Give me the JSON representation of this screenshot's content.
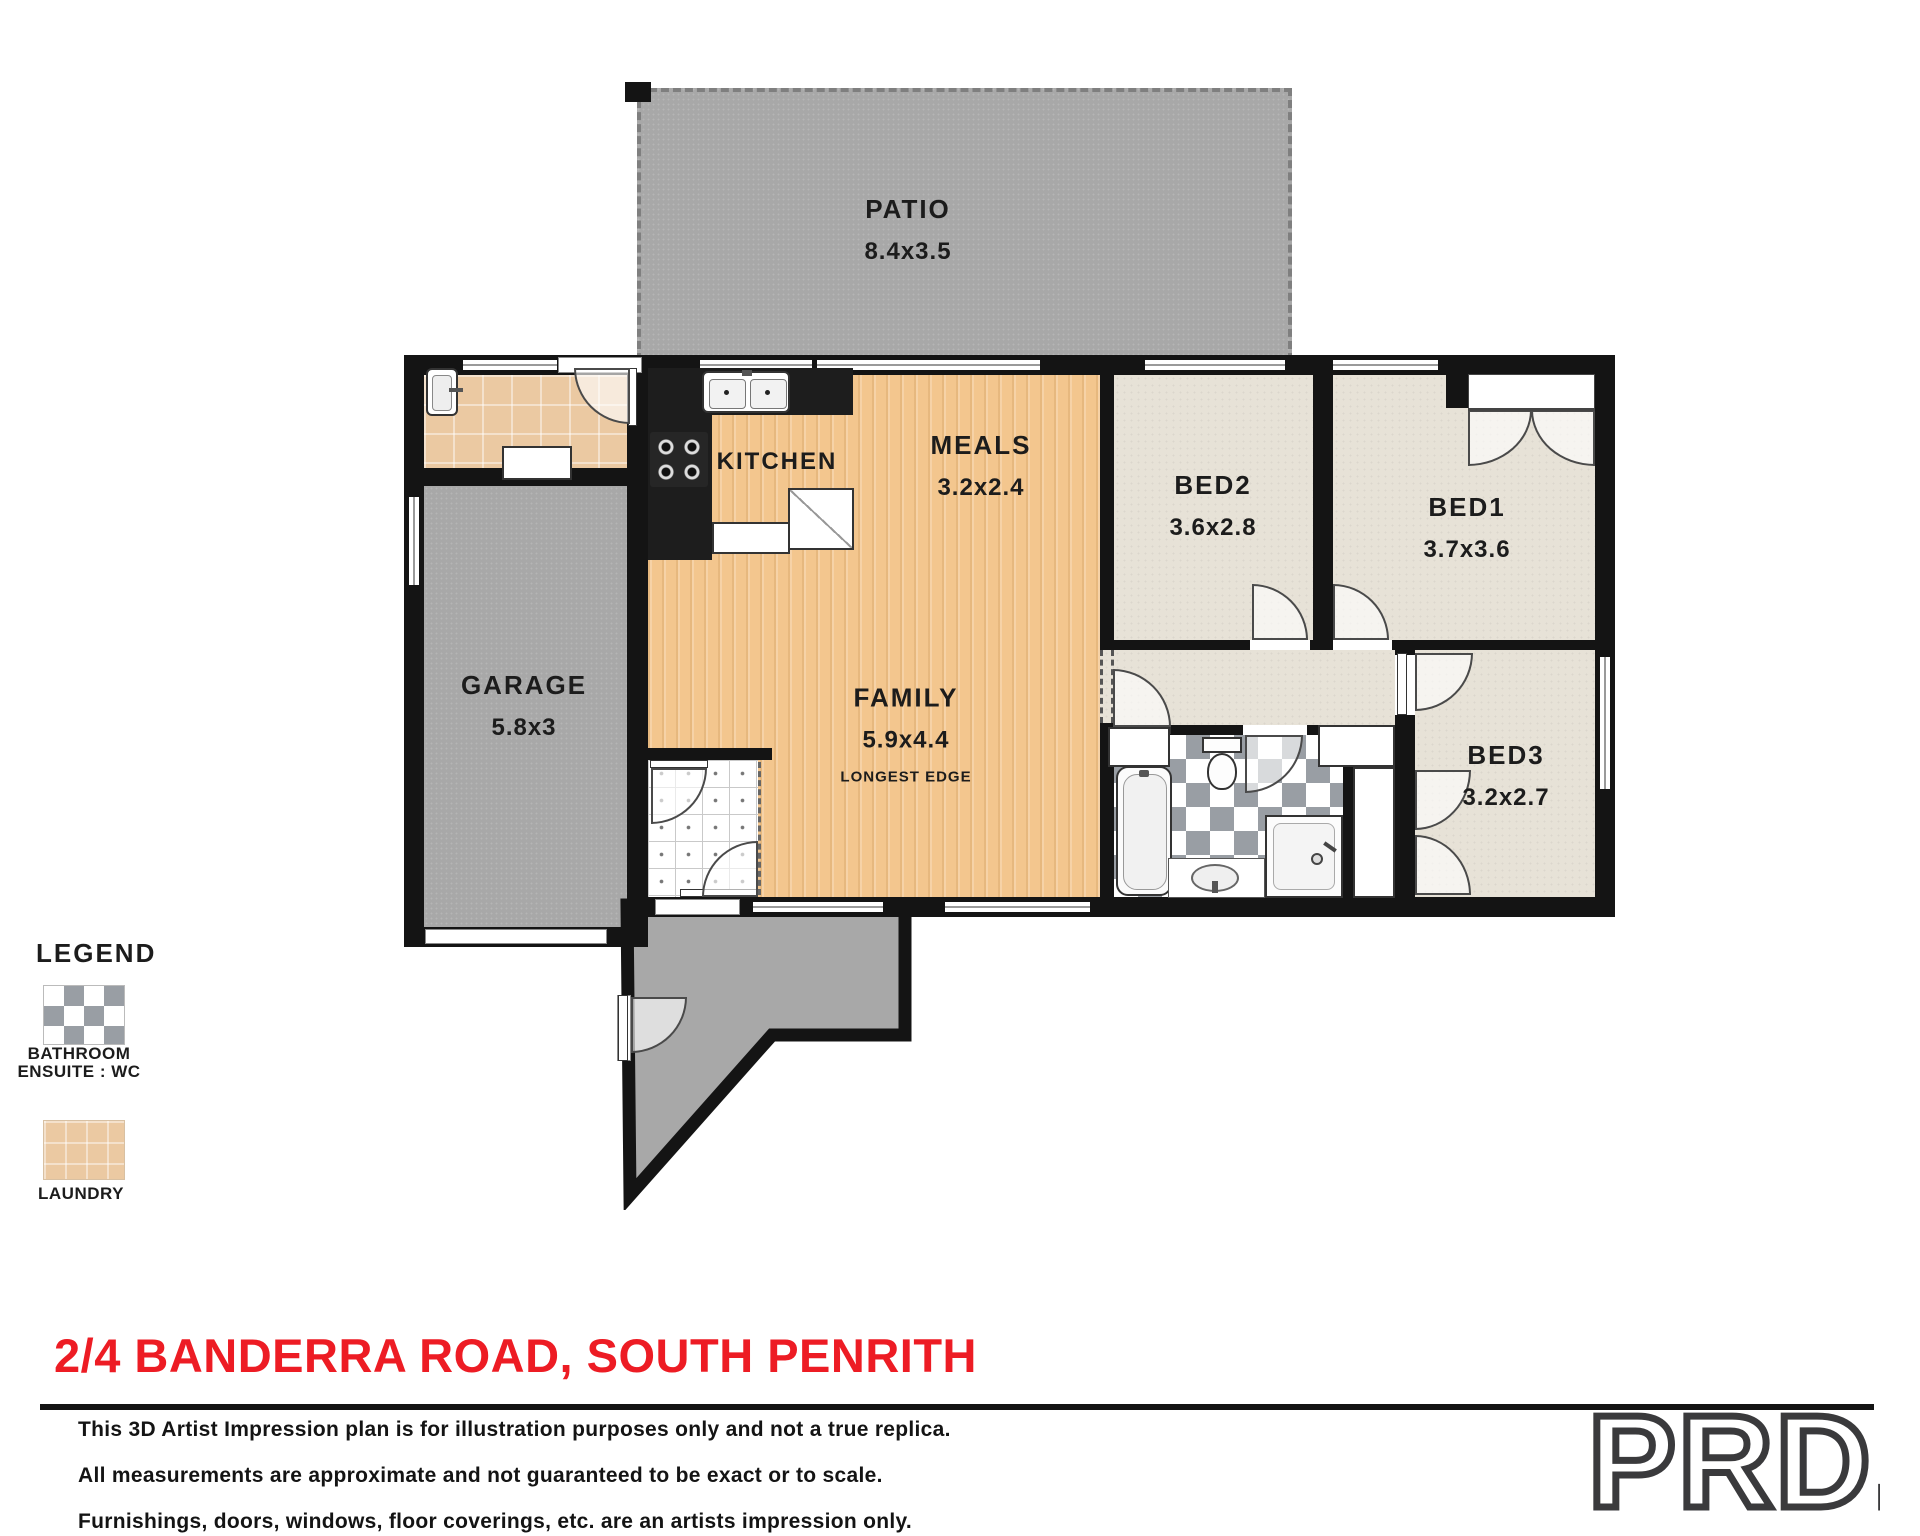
{
  "floorplan": {
    "rooms": {
      "patio": {
        "name": "PATIO",
        "dims": "8.4x3.5"
      },
      "kitchen": {
        "name": "KITCHEN"
      },
      "meals": {
        "name": "MEALS",
        "dims": "3.2x2.4"
      },
      "bed2": {
        "name": "BED2",
        "dims": "3.6x2.8"
      },
      "bed1": {
        "name": "BED1",
        "dims": "3.7x3.6"
      },
      "garage": {
        "name": "GARAGE",
        "dims": "5.8x3"
      },
      "family": {
        "name": "FAMILY",
        "dims": "5.9x4.4",
        "note": "LONGEST EDGE"
      },
      "bed3": {
        "name": "BED3",
        "dims": "3.2x2.7"
      }
    },
    "colors": {
      "wall": "#141414",
      "wood_floor": "#f3c68e",
      "carpet": "#e7e2d7",
      "outdoor_gray": "#a8a8a8",
      "laundry_tile": "#ebc9a2",
      "checker_gray": "#999ea4",
      "accent_red": "#ed1c24"
    }
  },
  "legend": {
    "title": "LEGEND",
    "items": [
      {
        "lines": [
          "BATHROOM",
          "ENSUITE : WC"
        ],
        "swatch": "checker-swatch"
      },
      {
        "lines": [
          "LAUNDRY"
        ],
        "swatch": "laundry-tile-swatch"
      }
    ]
  },
  "footer": {
    "address": "2/4 BANDERRA ROAD, SOUTH PENRITH",
    "disclaimer": [
      "This 3D Artist Impression plan is for illustration purposes only and not a true replica.",
      "All measurements are approximate and not guaranteed to be exact or to scale.",
      "Furnishings, doors, windows, floor coverings, etc. are an artists impression only."
    ],
    "brand": "PRD."
  }
}
